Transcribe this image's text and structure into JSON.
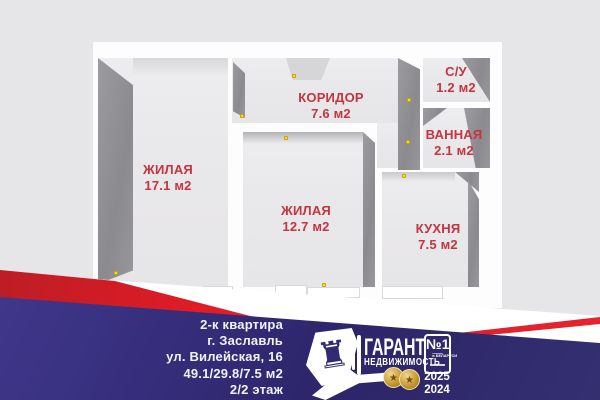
{
  "plan": {
    "rooms": [
      {
        "name": "ЖИЛАЯ",
        "area": "17.1 м2"
      },
      {
        "name": "КОРИДОР",
        "area": "7.6 м2"
      },
      {
        "name": "С/У",
        "area": "1.2 м2"
      },
      {
        "name": "ВАННАЯ",
        "area": "2.1 м2"
      },
      {
        "name": "ЖИЛАЯ",
        "area": "12.7 м2"
      },
      {
        "name": "КУХНЯ",
        "area": "7.5 м2"
      }
    ],
    "label_color": "#c4353f",
    "door_handle_color": "#ffe20a"
  },
  "listing": {
    "lines": [
      "2-к квартира",
      "г. Заславль",
      "ул. Вилейская, 16",
      "49.1/29.8/7.5 м2",
      "2/2 этаж"
    ]
  },
  "brand": {
    "title": "ГАРАНТ",
    "subtitle": "НЕДВИЖИМОСТЬ",
    "badge_number": "№1",
    "badge_sub": "в БЕЛАРУСИ",
    "years": [
      "2025",
      "2024"
    ],
    "rook_glyph": "♜",
    "medal_glyph": "★",
    "colors": {
      "navy": "#2c2569",
      "red": "#e01b28",
      "gold": "#c89a33",
      "white": "#ffffff"
    }
  }
}
